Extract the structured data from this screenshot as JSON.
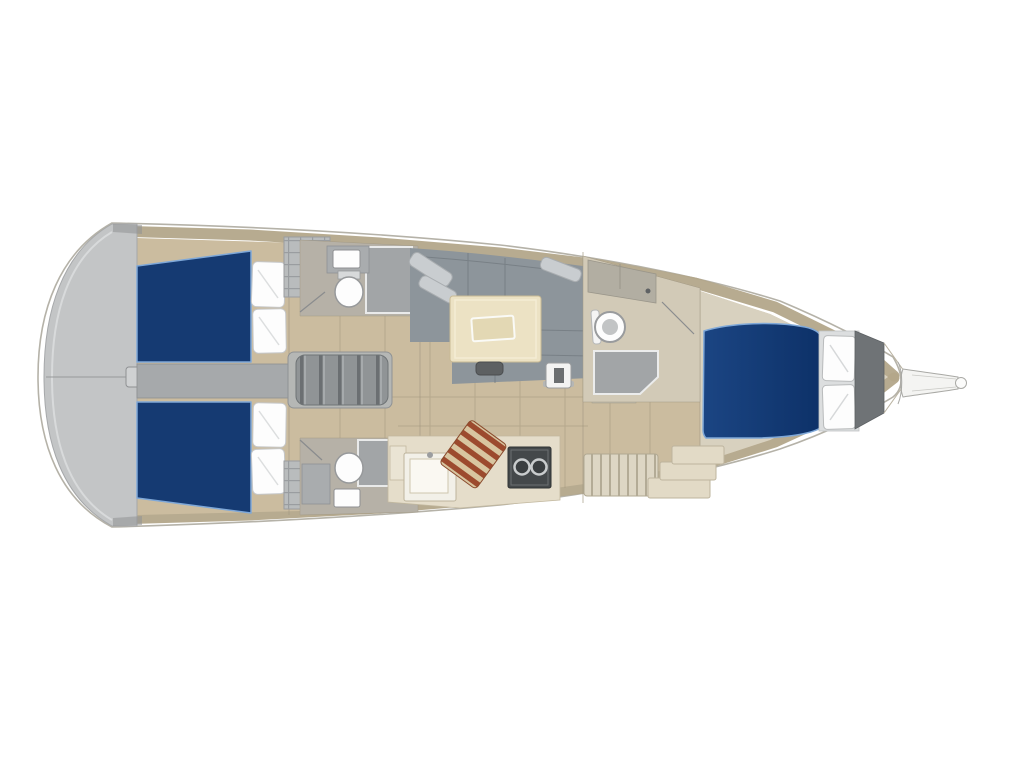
{
  "diagram": {
    "type": "yacht-interior-floor-plan",
    "orientation": "bow-pointing-right",
    "background": "#ffffff"
  },
  "colors": {
    "hull_outline": "#b5b2a8",
    "deck_band": "#b3a78a",
    "floor_teak": "#cbbc9f",
    "floor_seam": "#a2957a",
    "transom_gray": "#c3c5c6",
    "walkway_gray": "#a6a9ab",
    "berth_blue": "#153a72",
    "berth_blue_light": "#1b4583",
    "berth_blue_dark": "#0d3168",
    "berth_edge": "#7fa8d8",
    "pillow_white": "#fdfdfd",
    "pillow_platform": "#dcdedf",
    "sofa_gray": "#8d959b",
    "sofa_seam": "#747b81",
    "sofa_pillow_gray": "#c9cdd0",
    "table_cream": "#ece2c4",
    "table_inset": "#e3d8b4",
    "table_leg": "#5d6062",
    "galley_cabinet": "#e5ddca",
    "galley_white": "#f2f0e8",
    "stove_dark": "#44484a",
    "burner_ring": "#c9cccd",
    "board_stripe_red": "#9c4a2e",
    "board_stripe_tan": "#d8c5a0",
    "head_floor": "#b6b1a7",
    "shower_gray": "#a2a5a7",
    "counter_gray": "#a9acae",
    "locker_gray": "#b9bcbd",
    "locker_line": "#9a9da0",
    "steps_gray": "#909496",
    "steps_rib": "#6b6f72",
    "bench_slat_bg": "#ddd6c4",
    "bench_slat_line": "#b3ab96",
    "step_cream": "#e2dac6",
    "fwd_floor": "#d8d1bf",
    "fwd_head_floor": "#d2cab7",
    "fwd_counter": "#b2aea2",
    "anchor_locker": "#6f7376",
    "bowsprit_fill": "#f4f4f2",
    "bulkhead_line": "#a59b84"
  },
  "areas": [
    {
      "name": "swim-platform",
      "label": "Stern swim platform / transom",
      "color_ref": "transom_gray"
    },
    {
      "name": "aft-cabin-port",
      "label": "Aft double cabin, port side (blue berth with two pillows)",
      "color_ref": "berth_blue"
    },
    {
      "name": "aft-cabin-starboard",
      "label": "Aft double cabin, starboard side (blue berth with two pillows)",
      "color_ref": "berth_blue"
    },
    {
      "name": "engine-walkway",
      "label": "Center walkway between aft cabins",
      "color_ref": "walkway_gray"
    },
    {
      "name": "aft-head-port",
      "label": "Aft bathroom, port (toilet, sink, shower)",
      "color_ref": "head_floor"
    },
    {
      "name": "aft-head-starboard",
      "label": "Aft bathroom, starboard (toilet, sink, shower)",
      "color_ref": "head_floor"
    },
    {
      "name": "companionway-steps",
      "label": "Companionway steps",
      "color_ref": "steps_gray"
    },
    {
      "name": "salon",
      "label": "Salon with U-shaped settee and table",
      "color_ref": "sofa_gray"
    },
    {
      "name": "mast-base",
      "label": "Mast compression post",
      "color_ref": "pillow_white"
    },
    {
      "name": "galley",
      "label": "Galley (sink, cutting board, two-burner stove)",
      "color_ref": "galley_cabinet"
    },
    {
      "name": "nav-bench",
      "label": "Slatted bench and steps",
      "color_ref": "bench_slat_bg"
    },
    {
      "name": "forward-head",
      "label": "Forward bathroom (round toilet, shower pan)",
      "color_ref": "fwd_head_floor"
    },
    {
      "name": "forward-cabin",
      "label": "Forward V-berth cabin (blue mattress, two pillows)",
      "color_ref": "berth_blue"
    },
    {
      "name": "anchor-locker",
      "label": "Anchor locker",
      "color_ref": "anchor_locker"
    },
    {
      "name": "bowsprit",
      "label": "Bowsprit",
      "color_ref": "bowsprit_fill"
    }
  ]
}
